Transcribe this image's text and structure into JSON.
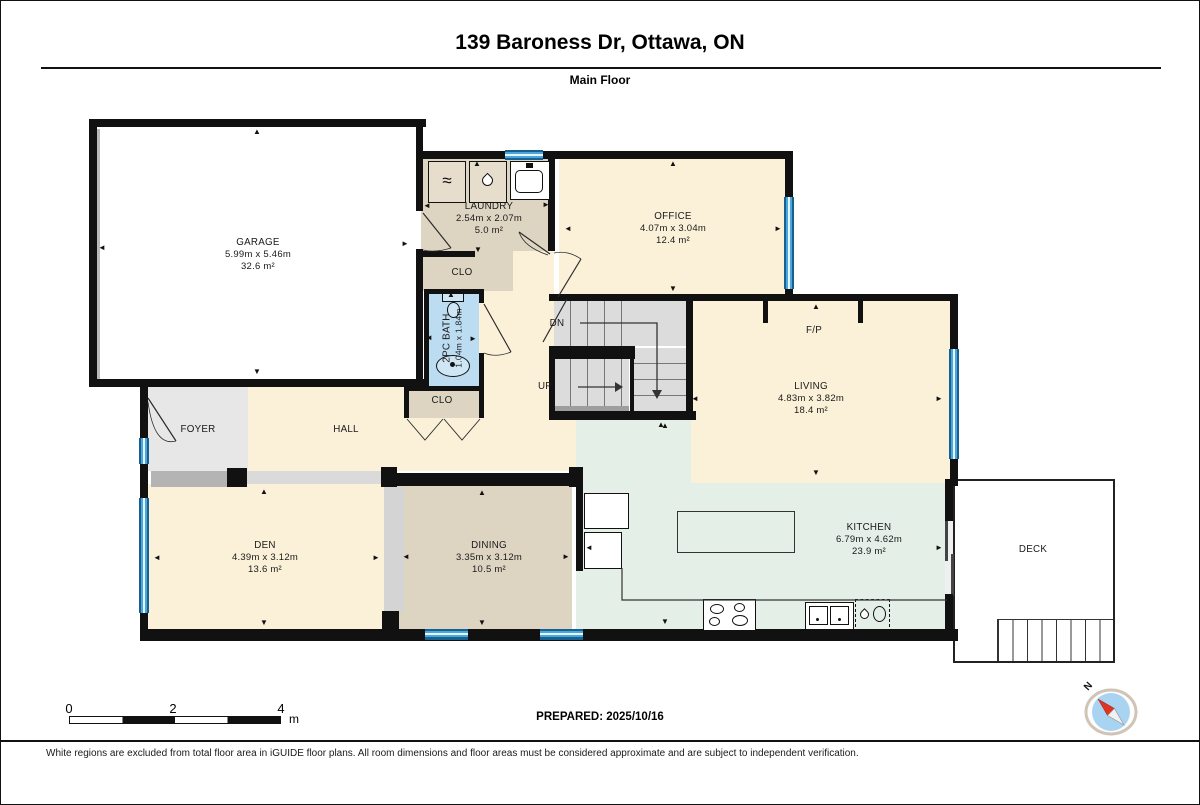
{
  "header": {
    "title": "139 Baroness Dr, Ottawa, ON",
    "subtitle": "Main Floor"
  },
  "rooms": {
    "garage": {
      "name": "GARAGE",
      "dims": "5.99m x 5.46m",
      "area": "32.6 m²"
    },
    "laundry": {
      "name": "LAUNDRY",
      "dims": "2.54m x 2.07m",
      "area": "5.0 m²"
    },
    "office": {
      "name": "OFFICE",
      "dims": "4.07m x 3.04m",
      "area": "12.4 m²"
    },
    "living": {
      "name": "LIVING",
      "dims": "4.83m x 3.82m",
      "area": "18.4 m²"
    },
    "den": {
      "name": "DEN",
      "dims": "4.39m x 3.12m",
      "area": "13.6 m²"
    },
    "dining": {
      "name": "DINING",
      "dims": "3.35m x 3.12m",
      "area": "10.5 m²"
    },
    "kitchen": {
      "name": "KITCHEN",
      "dims": "6.79m x 4.62m",
      "area": "23.9 m²"
    },
    "bath": {
      "name": "2PC BATH",
      "dims": "1.04m x 1.84m"
    },
    "foyer": {
      "name": "FOYER"
    },
    "hall": {
      "name": "HALL"
    },
    "closet_laundry": {
      "name": "CLO"
    },
    "closet_hall": {
      "name": "CLO"
    },
    "deck": {
      "name": "DECK"
    },
    "fireplace": {
      "name": "F/P"
    }
  },
  "stairs": {
    "up_label": "UP",
    "down_label": "DN"
  },
  "compass": {
    "north_label": "N"
  },
  "scale_bar": {
    "tick_0": "0",
    "tick_2": "2",
    "tick_4": "4",
    "unit": "m"
  },
  "footer": {
    "prepared": "PREPARED: 2025/10/16",
    "disclaimer": "White regions are excluded from total floor area in iGUIDE floor plans. All room dimensions and floor areas must be considered approximate and are subject to independent verification."
  },
  "icons": {
    "arrow_up": "▲",
    "arrow_down": "▼",
    "arrow_left": "◄",
    "arrow_right": "►",
    "washer": "≈"
  },
  "colors": {
    "wall": "#111111",
    "room_yellow": "#faf1d8",
    "room_tan": "#ded4c2",
    "room_gray": "#e7e7e7",
    "room_blue": "#bcdcf2",
    "room_green": "#e4efe8",
    "window_blue": "#4aa7dc",
    "compass_red": "#e03423"
  }
}
